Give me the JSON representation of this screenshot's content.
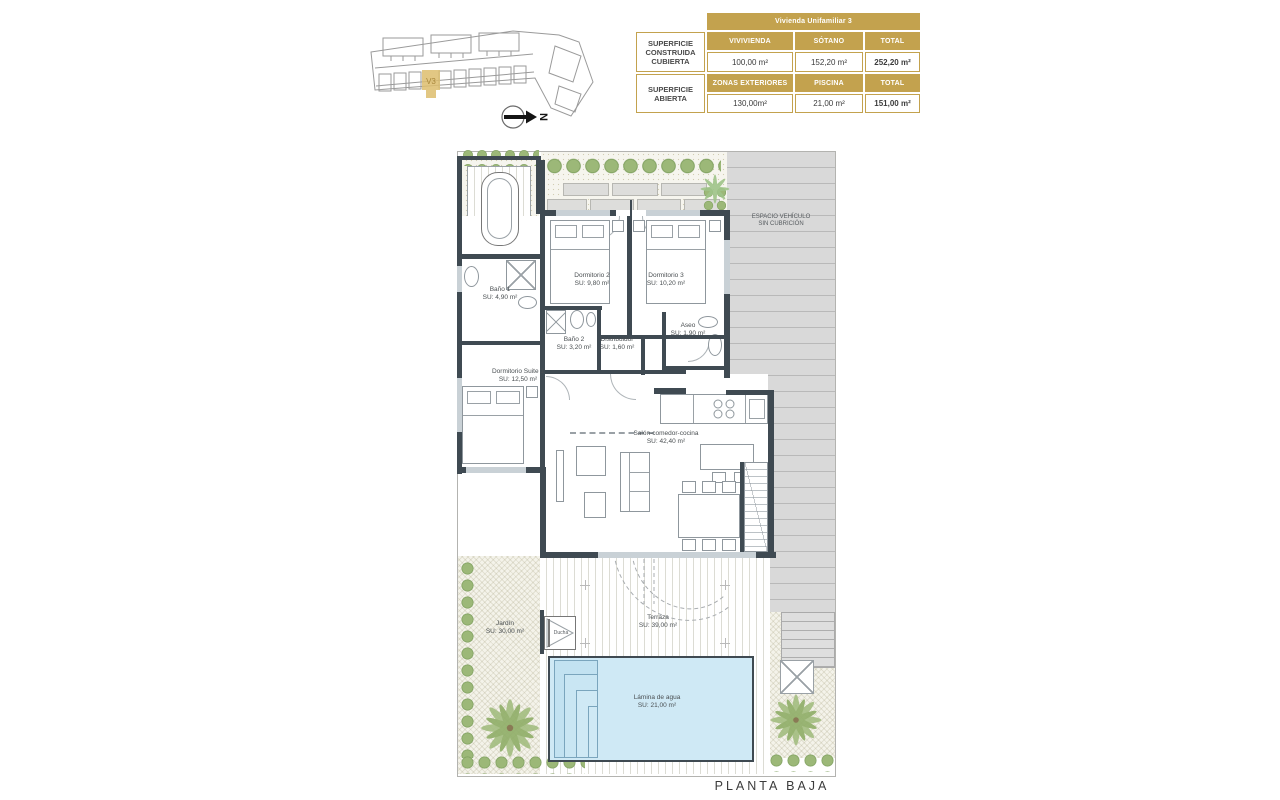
{
  "site_plan": {
    "unit_label": "V3",
    "north_label": "N"
  },
  "area_table": {
    "title": "Vivienda Unifamiliar 3",
    "groups": [
      {
        "label": "SUPERFICIE CONSTRUIDA CUBIERTA",
        "col1": "VIVIVIENDA",
        "col2": "SÓTANO",
        "col3": "TOTAL",
        "val1": "100,00 m²",
        "val2": "152,20 m²",
        "val3": "252,20 m²"
      },
      {
        "label": "SUPERFICIE ABIERTA",
        "col1": "ZONAS EXTERIORES",
        "col2": "PISCINA",
        "col3": "TOTAL",
        "val1": "130,00m²",
        "val2": "21,00 m²",
        "val3": "151,00 m²"
      }
    ]
  },
  "plan": {
    "rooms": [
      {
        "name": "Baño 1",
        "area": "SU: 4,90 m²"
      },
      {
        "name": "Dormitorio 2",
        "area": "SU: 9,80 m²"
      },
      {
        "name": "Dormitorio 3",
        "area": "SU: 10,20 m²"
      },
      {
        "name": "Baño 2",
        "area": "SU: 3,20 m²"
      },
      {
        "name": "Distribuidor",
        "area": "SU: 1,60 m²"
      },
      {
        "name": "Aseo",
        "area": "SU: 1,90 m²"
      },
      {
        "name": "Dormitorio Suite 1",
        "area": "SU: 12,50 m²"
      },
      {
        "name": "Salón-comedor-cocina",
        "area": "SU: 42,40 m²"
      },
      {
        "name": "Terraza",
        "area": "SU: 39,00 m²"
      },
      {
        "name": "Jardín",
        "area": "SU: 30,00 m²"
      },
      {
        "name": "Lámina de agua",
        "area": "SU: 21,00 m²"
      }
    ],
    "labels": {
      "vehicle_line1": "ESPACIO VEHÍCULO",
      "vehicle_line2": "SIN CUBRICIÓN",
      "shower": "Ducha"
    },
    "footer": "PLANTA BAJA"
  },
  "colors": {
    "gold": "#c3a24e",
    "wall": "#3f4a52",
    "pool_water": "#cfe9f5",
    "vegetation": "#9cb878"
  }
}
